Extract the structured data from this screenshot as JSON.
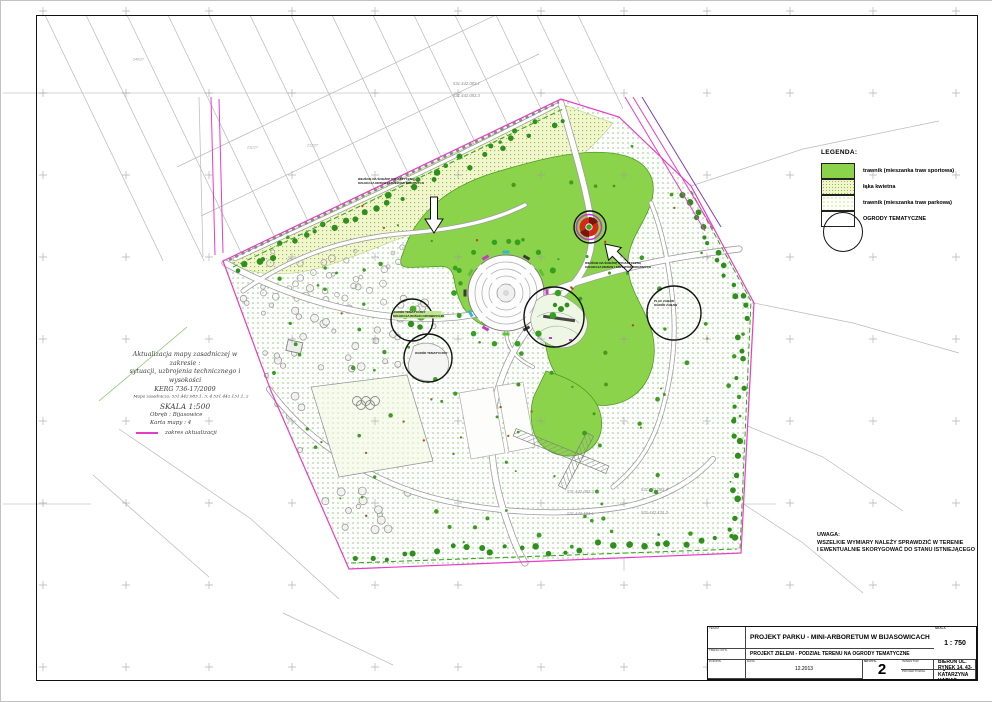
{
  "legend": {
    "title": "LEGENDA:",
    "items": [
      {
        "id": "sportowa",
        "label": "trawnik (mieszanka traw sportowa)"
      },
      {
        "id": "kwietna",
        "label": "łąka kwietna"
      },
      {
        "id": "parkowa",
        "label": "trawnik (mieszanka traw parkowa)"
      },
      {
        "id": "ogrody",
        "label": "OGRODY TEMATYCZNE"
      }
    ]
  },
  "note": {
    "title": "UWAGA:",
    "line1": "WSZELKIE WYMIARY NALEŻY SPRAWDZIĆ W TERENIE",
    "line2": "I EWENTUALNIE SKORYGOWAĆ DO STANU ISTNIEJĄCEGO"
  },
  "update_note": {
    "line1": "Aktualizacja mapy zasadniczej w zakresie :",
    "line2": "sytuacji, uzbrojenia technicznego i wysokości",
    "line3": "KERG    736-17/2009",
    "line4": "Mapa zasadnicza:  531.442.083.1, 3, 4    531.442.131.1, 2",
    "line5": "SKALA 1:500",
    "line6": "Obręb : Bijasowice",
    "line7": "Karta mapy : 4",
    "line8": "zakres aktualizacji"
  },
  "map_sheets": {
    "top1": "531.442.083.1",
    "top2": "531.442.083.3",
    "bottom_left_upper": "531.442.083.3",
    "bottom_right_upper": "531.442.083.4",
    "bottom_left_lower": "531.442.131.1",
    "bottom_right_lower": "531.442.131.2"
  },
  "parcels": {
    "p1": "240/27",
    "p2": "211/27",
    "p3": "212/27"
  },
  "annotations": {
    "entrance_north": {
      "line1": "WEJŚCIE NA ŚCIEŻKĘ DYDAKTYCZNĄ",
      "line2": "KOLEKCJA DRZEW I KRZEWÓW RODZIMYCH"
    },
    "entrance_east": {
      "line1": "WEJŚCIE NA ŚCIEŻKĘ DYDAKTYCZNĄ",
      "line2": "KOLEKCJA DRZEW I KRZEWÓW RODZIMYCH"
    },
    "garden1": {
      "line1": "OGRÓD TEMATYCZNY",
      "line2": "KOLEKCJA ROŚLIN OZDOBNYCH"
    },
    "garden2": {
      "line1": "OGRÓD TEMATYCZNY"
    },
    "playground": {
      "line1": "PLAC ZABAW",
      "line2": "OGRÓD ZABAW"
    }
  },
  "title_block": {
    "temat_label": "TEMAT",
    "temat": "PROJEKT PARKU - MINI-ARBORETUM W BIJASOWICACH",
    "tresc_label": "TREŚĆ RYS.",
    "tresc": "PROJEKT ZIELENI - PODZIAŁ TERENU NA OGRODY TEMATYCZNE",
    "inwestor_label": "INWESTOR",
    "inwestor": "GMINA  BIERUŃ  UL. RYNEK 14, 43-150 BIERUŃ",
    "projektowal_label": "PROJEKTOWAŁ",
    "projektowal": "mgr inż. KATARZYNA  KAPIAS",
    "skala_label": "SKALA",
    "skala": "1 : 750",
    "podpis_label": "PODPIS",
    "data_label": "DATA",
    "data": "12.2013",
    "nr_label": "NR RYS.",
    "nr": "2"
  },
  "colors": {
    "lawn_sport": "#8bd34a",
    "meadow": "#f2f6cf",
    "boundary_magenta": "#e83cc8",
    "accent_purple": "#7a3fc4",
    "tree_green": "#2f8f1d"
  }
}
